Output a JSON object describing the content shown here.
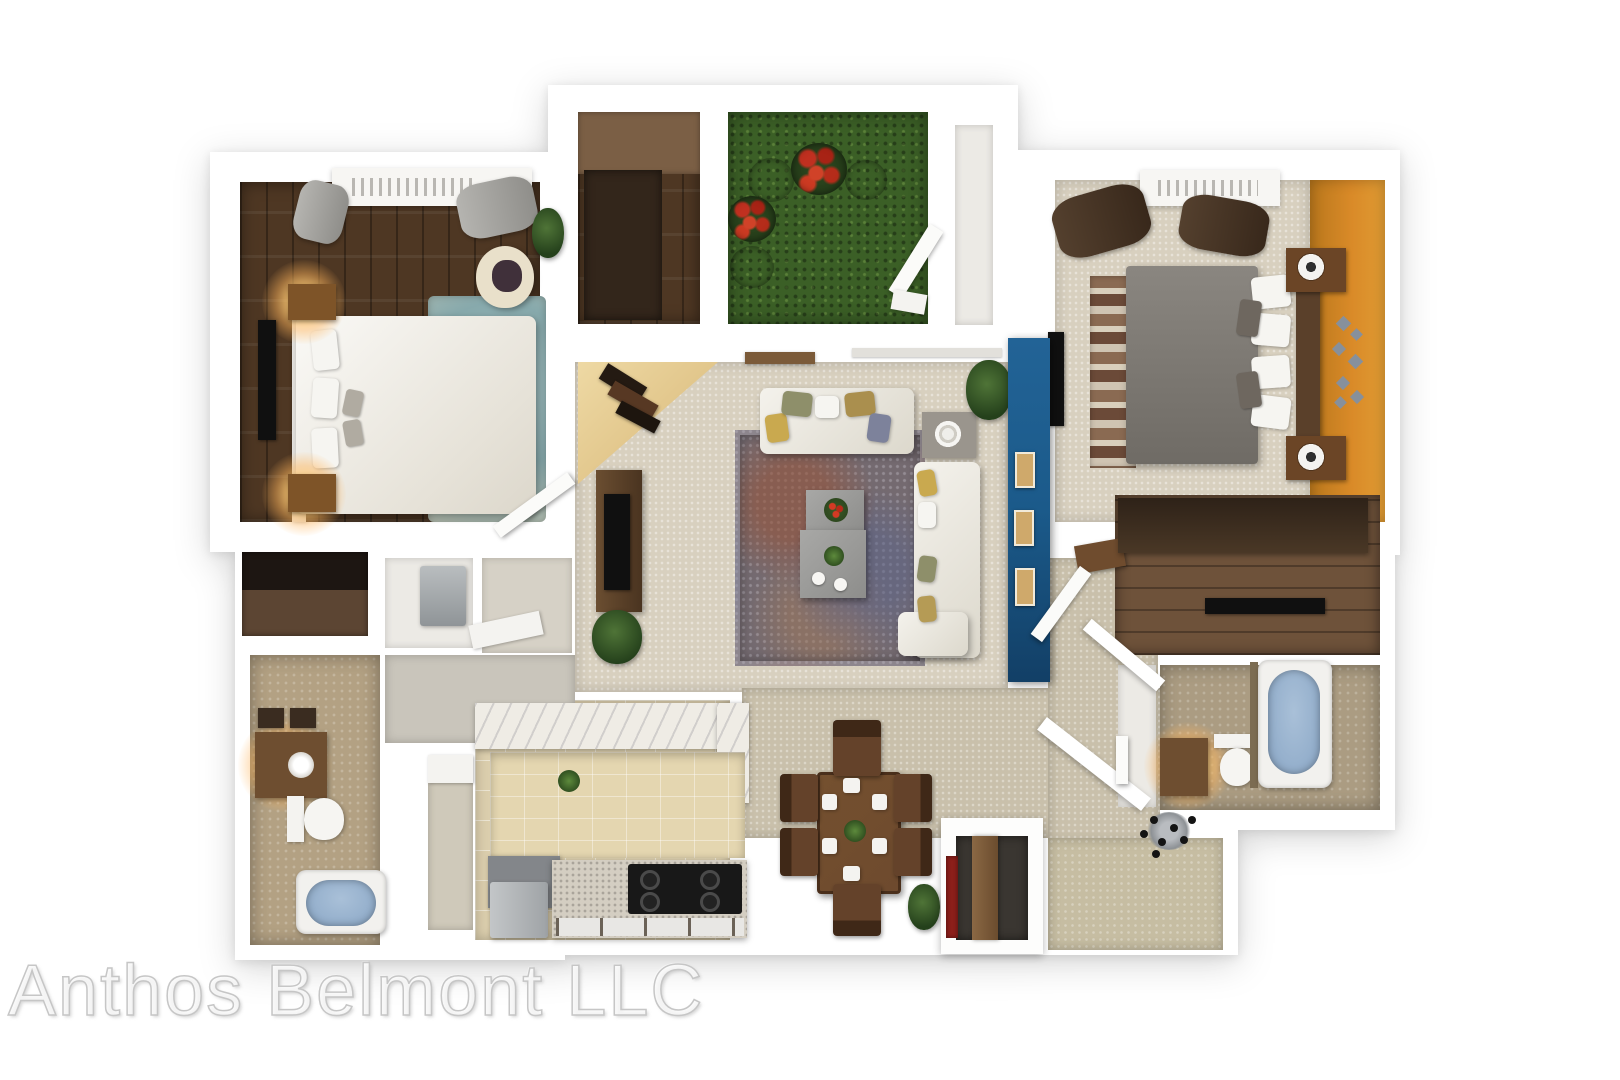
{
  "watermark": {
    "text": "Anthos Belmont LLC"
  },
  "palette": {
    "wall": "#ffffff",
    "wood_dark": "#4e3723",
    "wood_mid": "#6e523a",
    "carpet": "#d8d0bf",
    "carpet_dining": "#c9c0ab",
    "entry_khaki": "#c6bda2",
    "grass": "#3b5f26",
    "flower_red": "#c03020",
    "flower_blue": "#3c4f96",
    "accent_orange": "#d98a28",
    "accent_blue": "#1b5a8a",
    "rug_teal": "#87a9ac",
    "rug_living": "#746a70",
    "tub_blue": "#93aecb",
    "kitchen_tile": "#dbcead",
    "bath_tan": "#b3a183",
    "bed_gray": "#8a8680",
    "sofa_white": "#f4f2ec",
    "dining_wood": "#6e4a2e",
    "lamp_glow": "#ffcd78",
    "watermark_gray": "#c6c6c6"
  }
}
